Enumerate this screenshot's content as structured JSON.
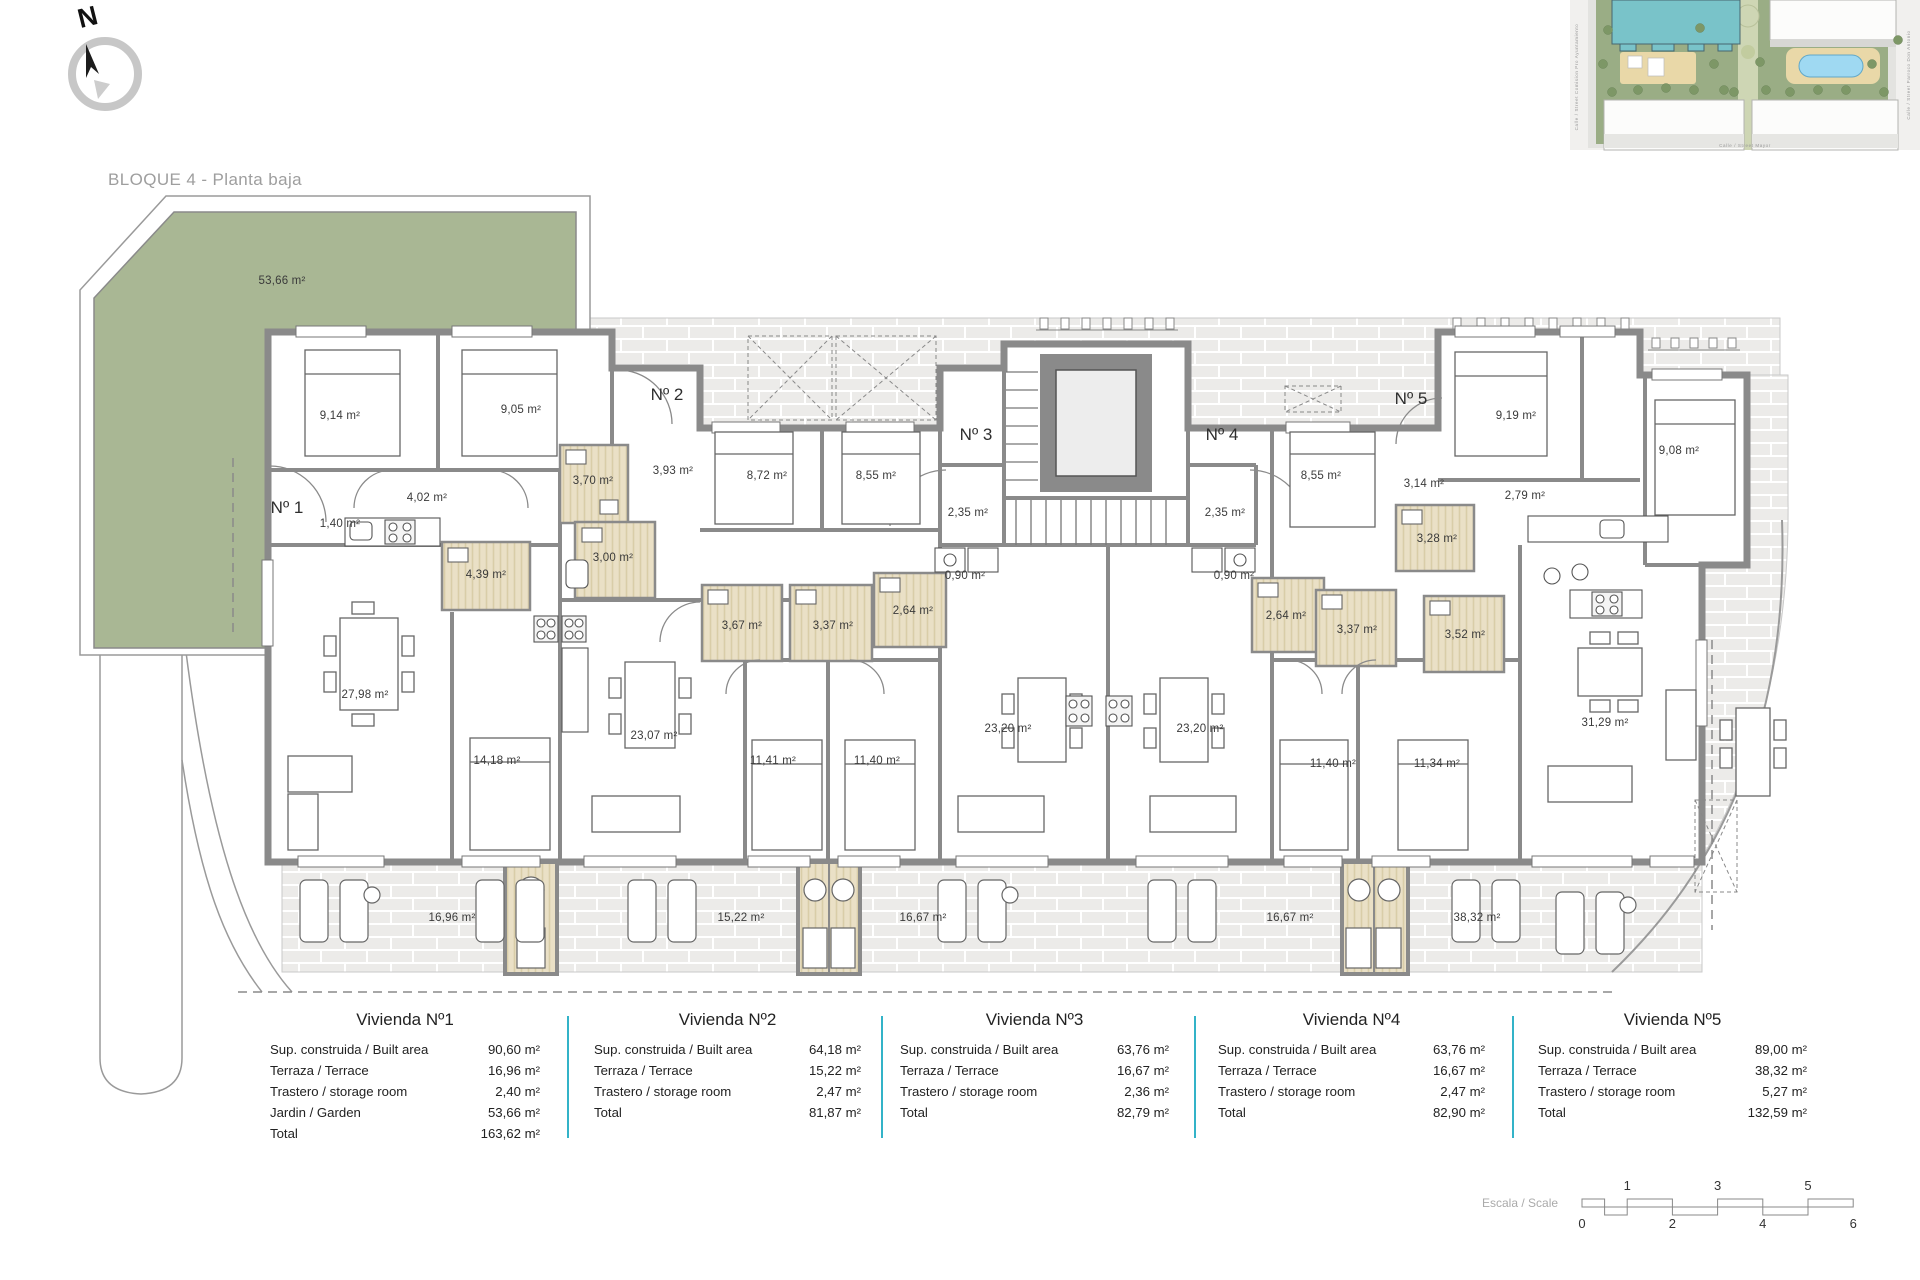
{
  "page": {
    "title": "BLOQUE 4 - Planta baja",
    "compass": "N"
  },
  "minimap": {
    "street_left": "Calle  /  Street   Comision  Pro  Ayuntamiento",
    "street_right": "Calle  /  Street   Parroco  Don  Antonio",
    "street_bottom": "Calle  /  Street   Mayor"
  },
  "plan": {
    "entrances": [
      {
        "label": "Nº 1",
        "x": 287,
        "y": 508
      },
      {
        "label": "Nº 2",
        "x": 667,
        "y": 395
      },
      {
        "label": "Nº 3",
        "x": 976,
        "y": 435
      },
      {
        "label": "Nº 4",
        "x": 1222,
        "y": 435
      },
      {
        "label": "Nº 5",
        "x": 1411,
        "y": 399
      }
    ],
    "room_labels": [
      {
        "label": "53,66 m²",
        "x": 282,
        "y": 281
      },
      {
        "label": "9,14 m²",
        "x": 340,
        "y": 416
      },
      {
        "label": "9,05 m²",
        "x": 521,
        "y": 410
      },
      {
        "label": "4,02 m²",
        "x": 427,
        "y": 498
      },
      {
        "label": "1,40 m²",
        "x": 340,
        "y": 524
      },
      {
        "label": "3,70 m²",
        "x": 593,
        "y": 481
      },
      {
        "label": "3,93 m²",
        "x": 673,
        "y": 471
      },
      {
        "label": "8,72 m²",
        "x": 767,
        "y": 476
      },
      {
        "label": "8,55 m²",
        "x": 876,
        "y": 476
      },
      {
        "label": "2,35 m²",
        "x": 968,
        "y": 513
      },
      {
        "label": "0,90 m²",
        "x": 965,
        "y": 576
      },
      {
        "label": "2,35 m²",
        "x": 1225,
        "y": 513
      },
      {
        "label": "0,90 m²",
        "x": 1234,
        "y": 576
      },
      {
        "label": "8,55 m²",
        "x": 1321,
        "y": 476
      },
      {
        "label": "3,14 m²",
        "x": 1424,
        "y": 484
      },
      {
        "label": "9,19 m²",
        "x": 1516,
        "y": 416
      },
      {
        "label": "2,79 m²",
        "x": 1525,
        "y": 496
      },
      {
        "label": "9,08 m²",
        "x": 1679,
        "y": 451
      },
      {
        "label": "3,28 m²",
        "x": 1437,
        "y": 539
      },
      {
        "label": "4,39 m²",
        "x": 486,
        "y": 575
      },
      {
        "label": "3,00 m²",
        "x": 613,
        "y": 558
      },
      {
        "label": "2,64 m²",
        "x": 913,
        "y": 611
      },
      {
        "label": "2,64 m²",
        "x": 1286,
        "y": 616
      },
      {
        "label": "3,67 m²",
        "x": 742,
        "y": 626
      },
      {
        "label": "3,37 m²",
        "x": 833,
        "y": 626
      },
      {
        "label": "3,37 m²",
        "x": 1357,
        "y": 630
      },
      {
        "label": "3,52 m²",
        "x": 1465,
        "y": 635
      },
      {
        "label": "27,98 m²",
        "x": 365,
        "y": 695
      },
      {
        "label": "23,07 m²",
        "x": 654,
        "y": 736
      },
      {
        "label": "23,20 m²",
        "x": 1008,
        "y": 729
      },
      {
        "label": "23,20 m²",
        "x": 1200,
        "y": 729
      },
      {
        "label": "31,29 m²",
        "x": 1605,
        "y": 723
      },
      {
        "label": "14,18 m²",
        "x": 497,
        "y": 761
      },
      {
        "label": "11,41 m²",
        "x": 773,
        "y": 761
      },
      {
        "label": "11,40 m²",
        "x": 877,
        "y": 761
      },
      {
        "label": "11,40 m²",
        "x": 1333,
        "y": 764
      },
      {
        "label": "11,34 m²",
        "x": 1437,
        "y": 764
      },
      {
        "label": "16,96 m²",
        "x": 452,
        "y": 918
      },
      {
        "label": "15,22 m²",
        "x": 741,
        "y": 918
      },
      {
        "label": "16,67 m²",
        "x": 923,
        "y": 918
      },
      {
        "label": "16,67 m²",
        "x": 1290,
        "y": 918
      },
      {
        "label": "38,32 m²",
        "x": 1477,
        "y": 918
      }
    ]
  },
  "tables": [
    {
      "title": "Vivienda Nº1",
      "left": 270,
      "width": 270,
      "rows": [
        {
          "label": "Sup. construida / Built area",
          "value": "90,60 m²"
        },
        {
          "label": "Terraza / Terrace",
          "value": "16,96 m²"
        },
        {
          "label": "Trastero / storage room",
          "value": "2,40 m²"
        },
        {
          "label": "Jardin / Garden",
          "value": "53,66 m²"
        },
        {
          "label": "Total",
          "value": "163,62 m²"
        }
      ]
    },
    {
      "title": "Vivienda Nº2",
      "left": 594,
      "width": 267,
      "rows": [
        {
          "label": "Sup. construida / Built area",
          "value": "64,18 m²"
        },
        {
          "label": "Terraza / Terrace",
          "value": "15,22 m²"
        },
        {
          "label": "Trastero / storage room",
          "value": "2,47 m²"
        },
        {
          "label": "Total",
          "value": "81,87 m²"
        }
      ]
    },
    {
      "title": "Vivienda Nº3",
      "left": 900,
      "width": 269,
      "rows": [
        {
          "label": "Sup. construida / Built area",
          "value": "63,76 m²"
        },
        {
          "label": "Terraza / Terrace",
          "value": "16,67 m²"
        },
        {
          "label": "Trastero / storage room",
          "value": "2,36 m²"
        },
        {
          "label": "Total",
          "value": "82,79 m²"
        }
      ]
    },
    {
      "title": "Vivienda Nº4",
      "left": 1218,
      "width": 267,
      "rows": [
        {
          "label": "Sup. construida / Built area",
          "value": "63,76 m²"
        },
        {
          "label": "Terraza / Terrace",
          "value": "16,67 m²"
        },
        {
          "label": "Trastero / storage room",
          "value": "2,47 m²"
        },
        {
          "label": "Total",
          "value": "82,90 m²"
        }
      ]
    },
    {
      "title": "Vivienda Nº5",
      "left": 1538,
      "width": 269,
      "rows": [
        {
          "label": "Sup. construida / Built area",
          "value": "89,00 m²"
        },
        {
          "label": "Terraza / Terrace",
          "value": "38,32 m²"
        },
        {
          "label": "Trastero / storage room",
          "value": "5,27 m²"
        },
        {
          "label": "Total",
          "value": "132,59 m²"
        }
      ]
    }
  ],
  "scale": {
    "label": "Escala / Scale",
    "ticks_above": [
      1,
      3,
      5
    ],
    "ticks_below": [
      0,
      2,
      4,
      6
    ]
  },
  "colors": {
    "garden_green": "#a9b794",
    "wall_gray": "#8a8a8a",
    "bath_beige": "#eae0c6",
    "terrace_tile": "#ecebe9",
    "table_divider_teal": "#33b3c8",
    "minimap_building_teal": "#79c3c9",
    "minimap_pool_blue": "#9fd9f2",
    "minimap_green": "#9aad85"
  }
}
